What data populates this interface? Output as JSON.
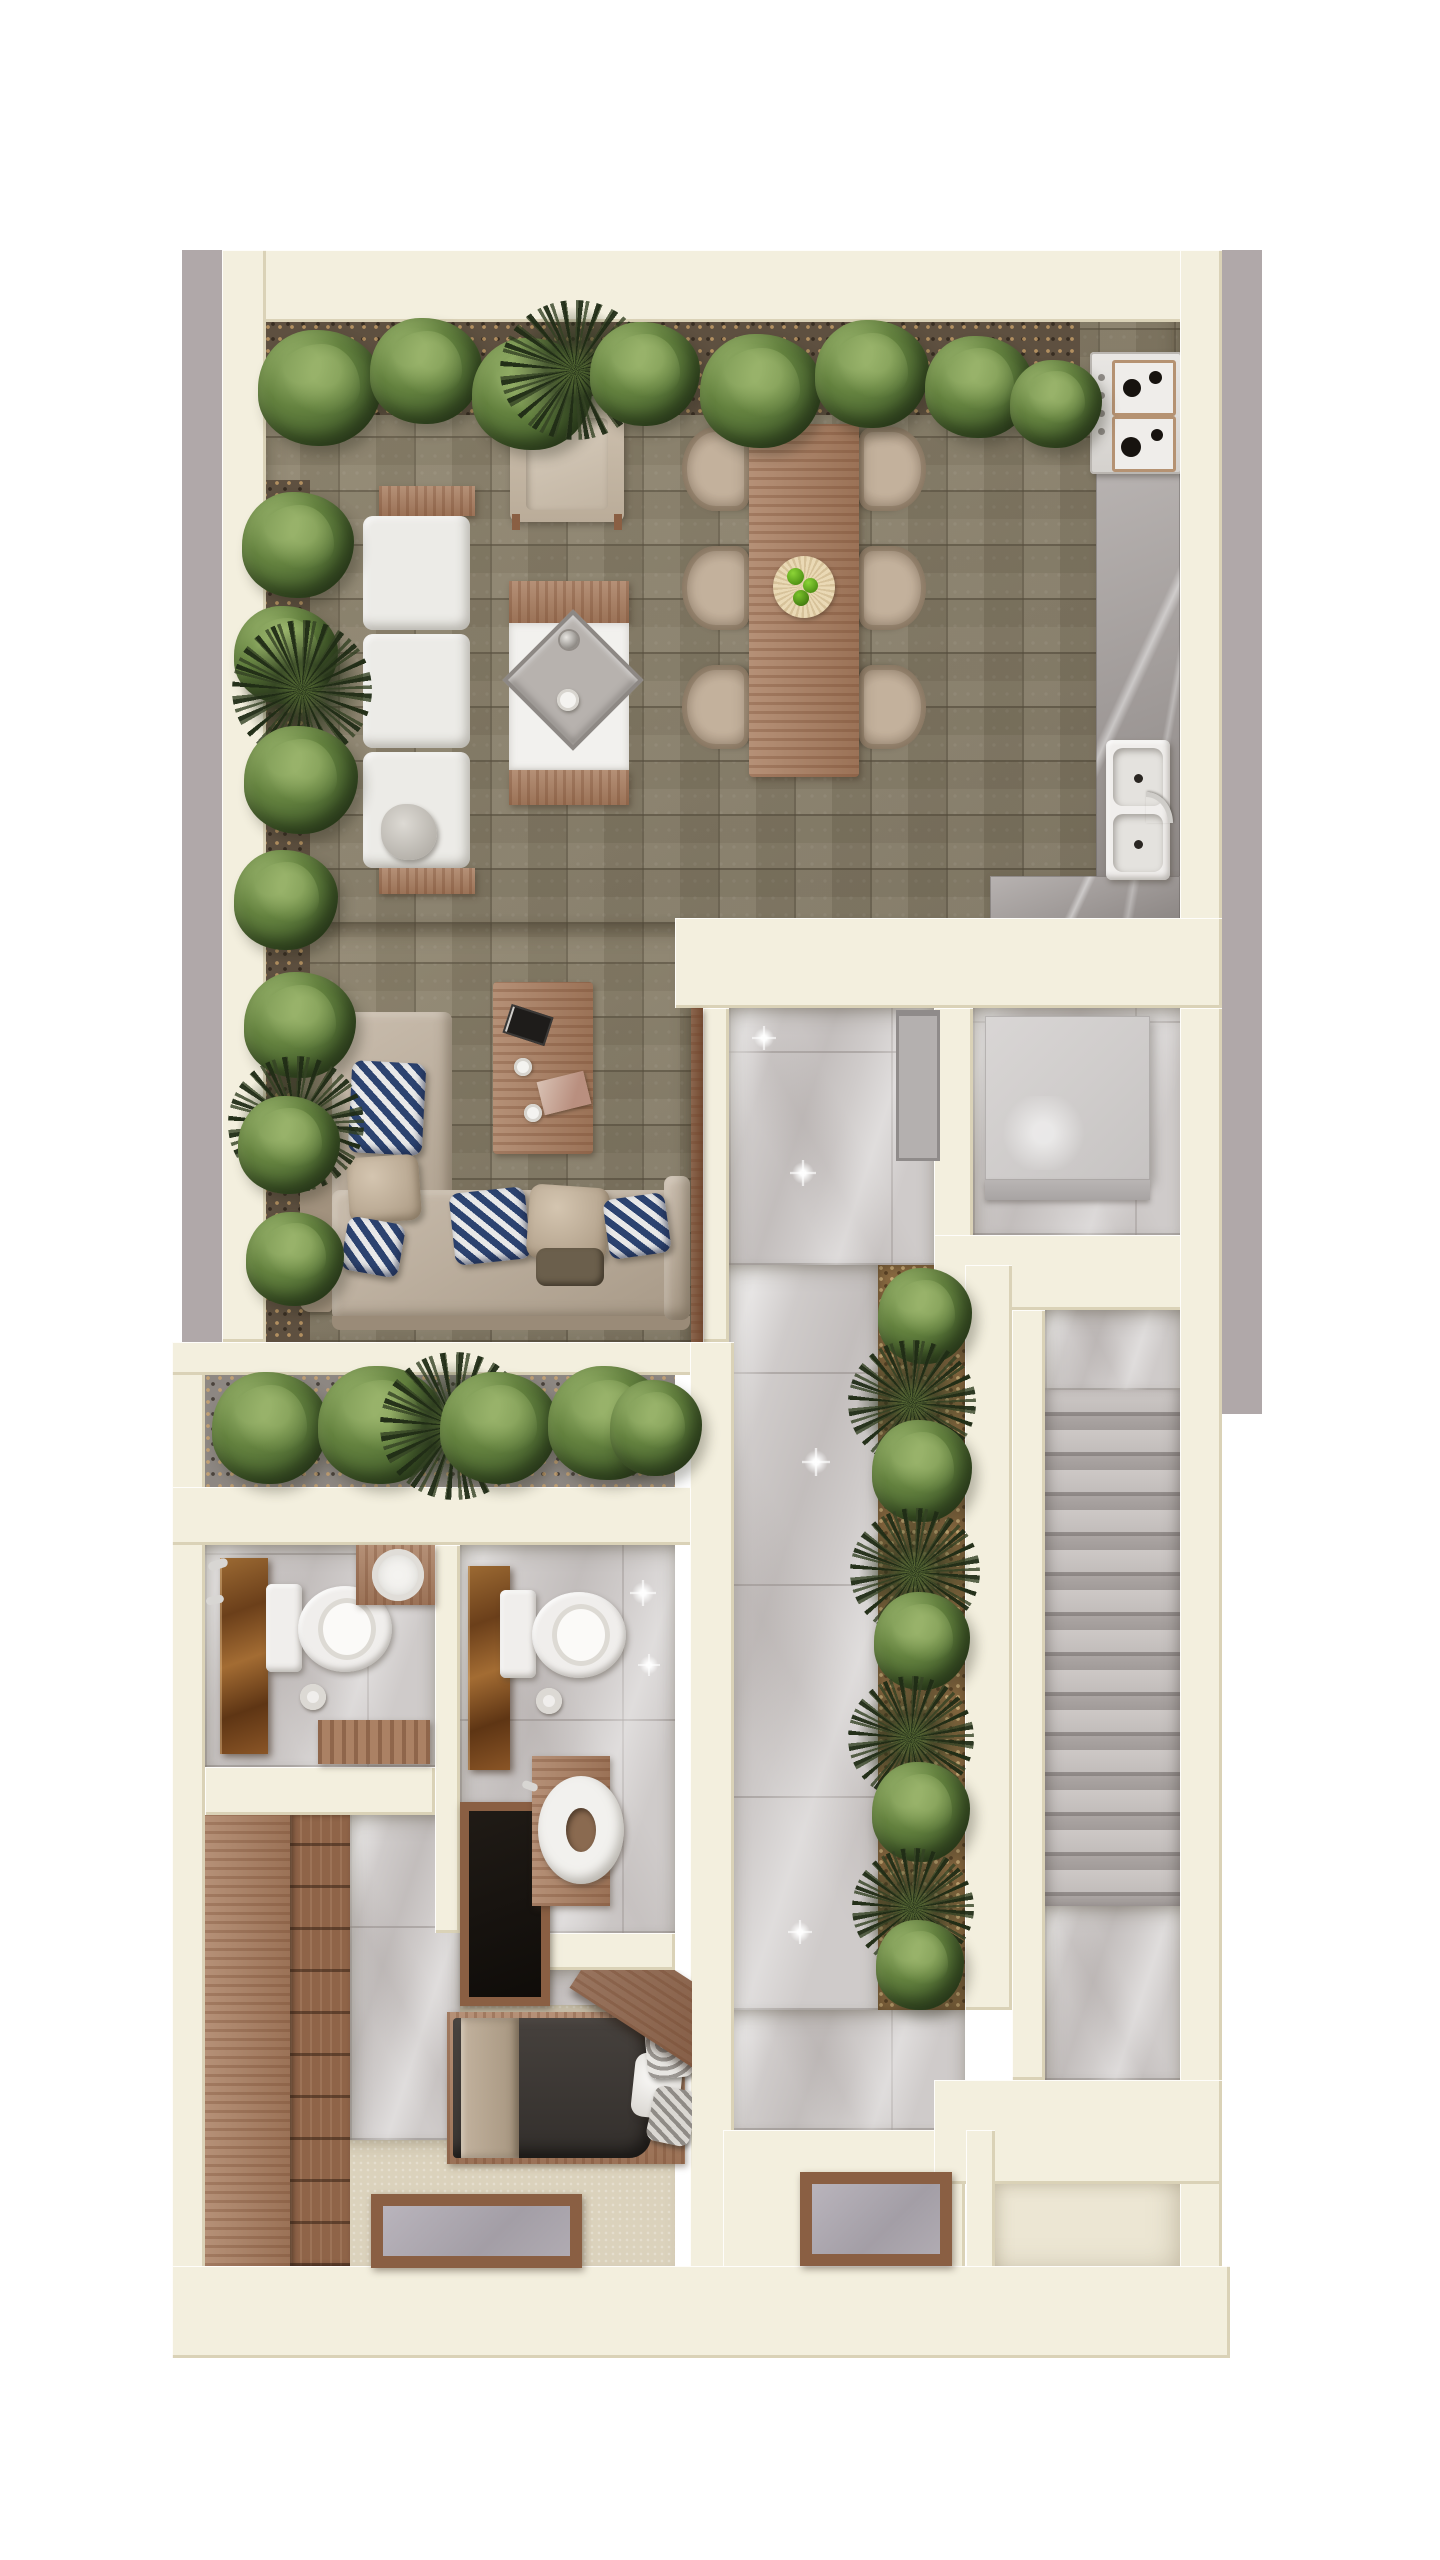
{
  "scene": {
    "title": "Top-down 3D architectural floor plan render of a narrow single-family home level",
    "view": "top-down axonometric",
    "background": "#ffffff",
    "visible_text": "none"
  },
  "palette": {
    "page_bg": "#ffffff",
    "exterior_band": "#b0a8a9",
    "wall_cream": "#f3efde",
    "stone_floor": "#978d77",
    "marble_tile": "#cfcbca",
    "counter_gray": "#a8a2a0",
    "carpet_beige": "#dbd2bc",
    "wood": "#ab8164",
    "plant_green": "#5f7c40",
    "palm_dark": "#26331b",
    "pillow_navy": "#2c4370",
    "rust_vanity_marble": "#8a5526",
    "bed_duvet_charcoal": "#3a3633",
    "glass_gray": "#a8a3ab",
    "apple_green": "#5fae1f"
  },
  "rooms": [
    {
      "id": "terrace",
      "name": "Open terrace lounge with stone paving and perimeter planting"
    },
    {
      "id": "dining",
      "name": "Outdoor dining area with table for six"
    },
    {
      "id": "kitchen",
      "name": "Kitchen counter run with stove and double sink"
    },
    {
      "id": "living",
      "name": "Lounge seating area with L-shaped sectional"
    },
    {
      "id": "planter-strip",
      "name": "Interior planter strip"
    },
    {
      "id": "bathroom-1",
      "name": "Bathroom 1 with toilet and stone vanity"
    },
    {
      "id": "bathroom-2",
      "name": "Bathroom 2 with toilet, washbasin stand and shower"
    },
    {
      "id": "closet",
      "name": "Wardrobe closet"
    },
    {
      "id": "bedroom",
      "name": "Bedroom with single bed and floor light-well"
    },
    {
      "id": "hallway",
      "name": "Hallway with large-format gray marble tiles"
    },
    {
      "id": "hall-planter",
      "name": "Hallway side planter with shrubs and palms"
    },
    {
      "id": "storage",
      "name": "Storage room with gray volume"
    },
    {
      "id": "stairs",
      "name": "Staircase with thirteen visible treads"
    },
    {
      "id": "entry",
      "name": "Lower entry room"
    }
  ],
  "furniture": [
    {
      "id": "white-sofa",
      "name": "White modular sofa with wood end benches"
    },
    {
      "id": "armchair",
      "name": "Beige lounge armchair"
    },
    {
      "id": "fire-table",
      "name": "Square fire-pit grill table with diamond insert, kettle and bowl"
    },
    {
      "id": "dining-table",
      "name": "Rectangular wood dining table"
    },
    {
      "id": "dining-chair",
      "name": "Beige shell dining chair"
    },
    {
      "id": "fruit-plate",
      "name": "Round plate with green apples"
    },
    {
      "id": "stove",
      "name": "Four-burner gas cooktop"
    },
    {
      "id": "kitchen-sink",
      "name": "Double-basin sink with faucet"
    },
    {
      "id": "sectional-sofa",
      "name": "Beige L-shaped sectional with navy chevron pillows"
    },
    {
      "id": "coffee-table",
      "name": "Wood coffee table with magazines and two cups"
    },
    {
      "id": "toilet",
      "name": "White toilet with tank and paper roll"
    },
    {
      "id": "vanity-partition",
      "name": "Rust marble vanity partition"
    },
    {
      "id": "round-basin",
      "name": "Round white countertop basin on wood shelf"
    },
    {
      "id": "ring-basin",
      "name": "White ring washbasin on wood stand"
    },
    {
      "id": "shower",
      "name": "Dark wood-framed shower pan"
    },
    {
      "id": "bath-mat",
      "name": "Wood slat bath mat"
    },
    {
      "id": "wardrobe",
      "name": "Wood wardrobe with open shelving"
    },
    {
      "id": "bed",
      "name": "Single bed with charcoal duvet, beige throw and angled wood headboard"
    },
    {
      "id": "skylight",
      "name": "Wood-framed floor light-well with gray glass"
    },
    {
      "id": "storage-box",
      "name": "Large light-gray storage volume"
    },
    {
      "id": "hall-door",
      "name": "Gray framed door panel at hallway top"
    }
  ],
  "counts": {
    "dining_chairs": 6,
    "stair_treads_visible": 13,
    "bathrooms": 2,
    "floor_lightwells": 2,
    "top_row_bushes": 8,
    "left_column_bushes": 7,
    "mid_planter_bushes": 5,
    "hall_planter_bushes": 5,
    "palm_plants": 9
  }
}
